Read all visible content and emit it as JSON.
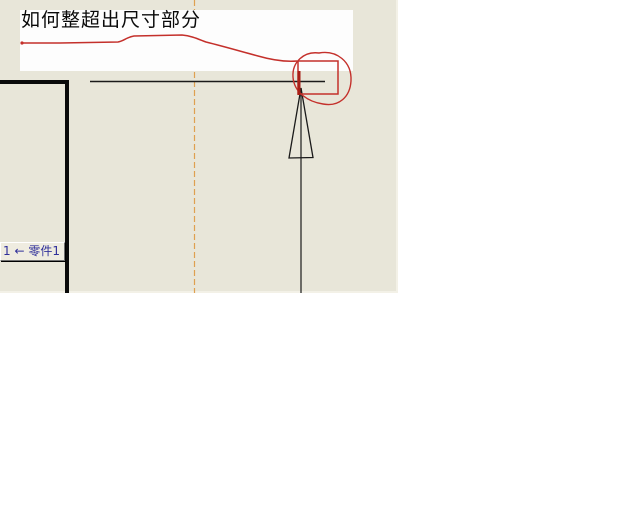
{
  "window": {
    "background_color": "#ffffff",
    "kind": "cad-drawing-screenshot"
  },
  "drawing_area": {
    "background_color": "#e8e6d9",
    "width_px": 398,
    "height_px": 293,
    "centerline_color": "#dfa050",
    "edge_color": "#1a1a1a"
  },
  "annotation": {
    "pen_color": "#c4302b",
    "title": "如何整超出尺寸部分",
    "note_box_color": "#fdfdfd",
    "marks": [
      "freehand-underline-curve",
      "highlight-rectangle",
      "highlight-circle"
    ]
  },
  "dimension": {
    "arrow_style": "open-triangle",
    "overshoot_highlighted": true
  },
  "balloon": {
    "label": "1 ← 零件1",
    "text_color": "#30309a",
    "background_color": "#efece0",
    "arrow_icon": "left-arrow"
  }
}
